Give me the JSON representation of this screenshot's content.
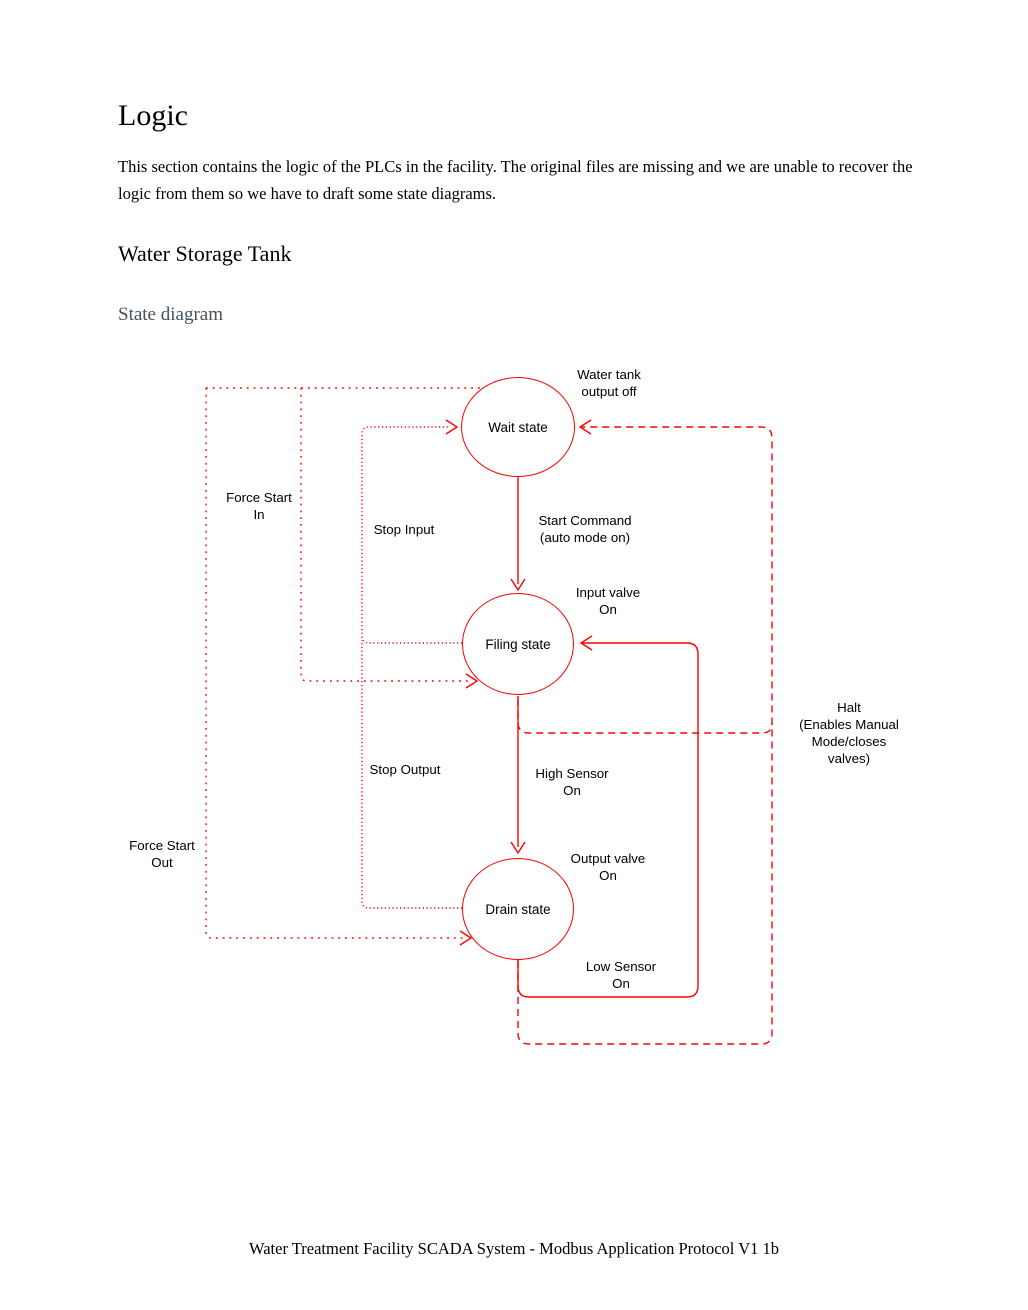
{
  "page": {
    "title": "Logic",
    "intro": "This section contains the logic of the PLCs in the facility. The original files are missing and we are unable to recover the logic from them so we have to draft some state diagrams.",
    "section_heading": "Water Storage Tank",
    "subsection_heading": "State diagram",
    "footer": "Water Treatment Facility SCADA System - Modbus Application Protocol V1 1b"
  },
  "diagram": {
    "states": {
      "wait": "Wait state",
      "filing": "Filing state",
      "drain": "Drain state"
    },
    "labels": {
      "water_tank_output_off": "Water tank\noutput off",
      "force_start_in": "Force Start\nIn",
      "stop_input": "Stop Input",
      "start_command": "Start Command\n(auto mode on)",
      "input_valve_on": "Input valve\nOn",
      "stop_output": "Stop Output",
      "high_sensor_on": "High Sensor\nOn",
      "force_start_out": "Force Start\nOut",
      "output_valve_on": "Output valve\nOn",
      "low_sensor_on": "Low Sensor\nOn",
      "halt": "Halt\n(Enables Manual\nMode/closes\nvalves)"
    },
    "colors": {
      "line": "#ff0000",
      "text": "#000000",
      "subheading": "#47525b"
    }
  }
}
